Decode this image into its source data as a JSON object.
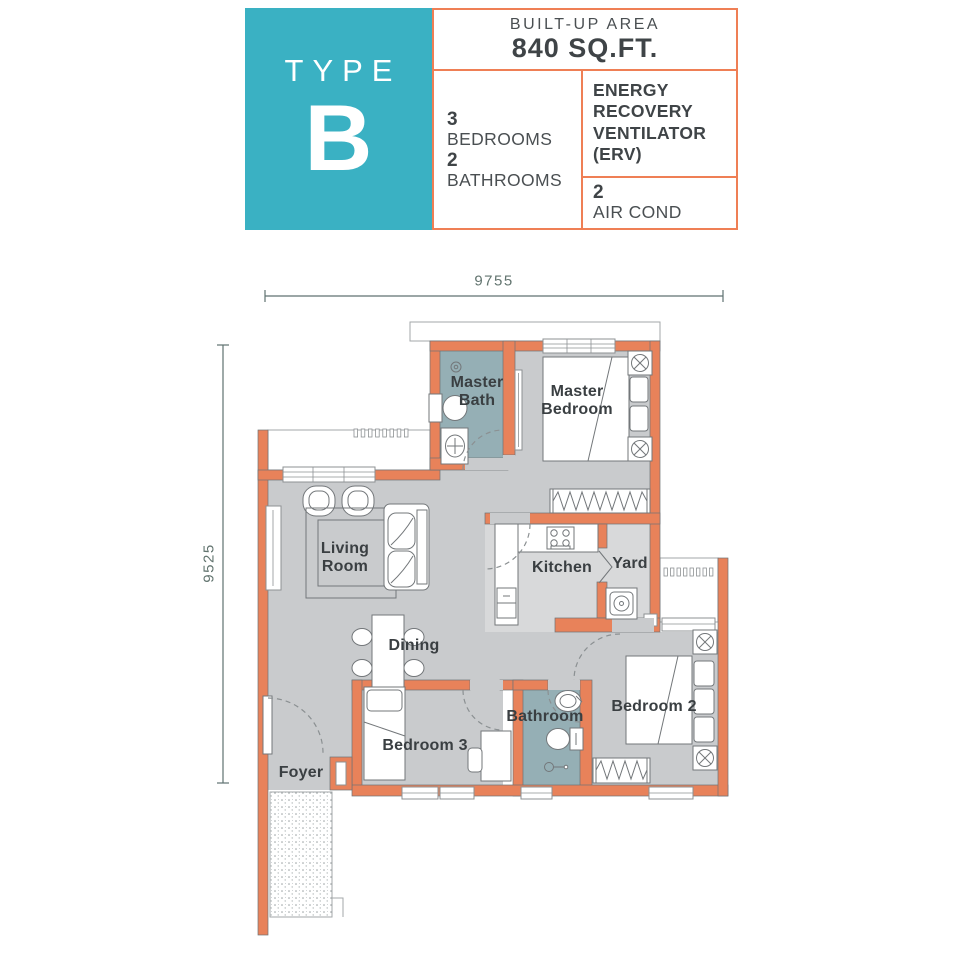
{
  "header": {
    "type_label": "TYPE",
    "type_letter": "B",
    "built_up": {
      "label": "BUILT-UP AREA",
      "value": "840 SQ.FT."
    },
    "bedrooms": {
      "count": "3",
      "label": "BEDROOMS"
    },
    "bathrooms": {
      "count": "2",
      "label": "BATHROOMS"
    },
    "erv": {
      "label": "ENERGY\nRECOVERY\nVENTILATOR\n(ERV)"
    },
    "air_cond": {
      "count": "2",
      "label": "AIR COND"
    }
  },
  "dimensions": {
    "width": "9755",
    "depth": "9525"
  },
  "rooms": {
    "master_bath": {
      "label": "Master\nBath"
    },
    "master_bedroom": {
      "label": "Master\nBedroom"
    },
    "living_room": {
      "label": "Living\nRoom"
    },
    "kitchen": {
      "label": "Kitchen"
    },
    "yard": {
      "label": "Yard"
    },
    "dining": {
      "label": "Dining"
    },
    "bathroom": {
      "label": "Bathroom"
    },
    "bedroom_2": {
      "label": "Bedroom 2"
    },
    "bedroom_3": {
      "label": "Bedroom 3"
    },
    "foyer": {
      "label": "Foyer"
    }
  },
  "colors": {
    "type_box_teal": "#3ab1c3",
    "info_border_orange": "#ef7f55",
    "wall_orange": "#e8825a",
    "floor_gray": "#c9cbcd",
    "floor_light_gray": "#d8d9da",
    "bath_floor_teal": "#95afb5",
    "text_dark": "#3f4447",
    "dimension_text": "#5f7270"
  }
}
